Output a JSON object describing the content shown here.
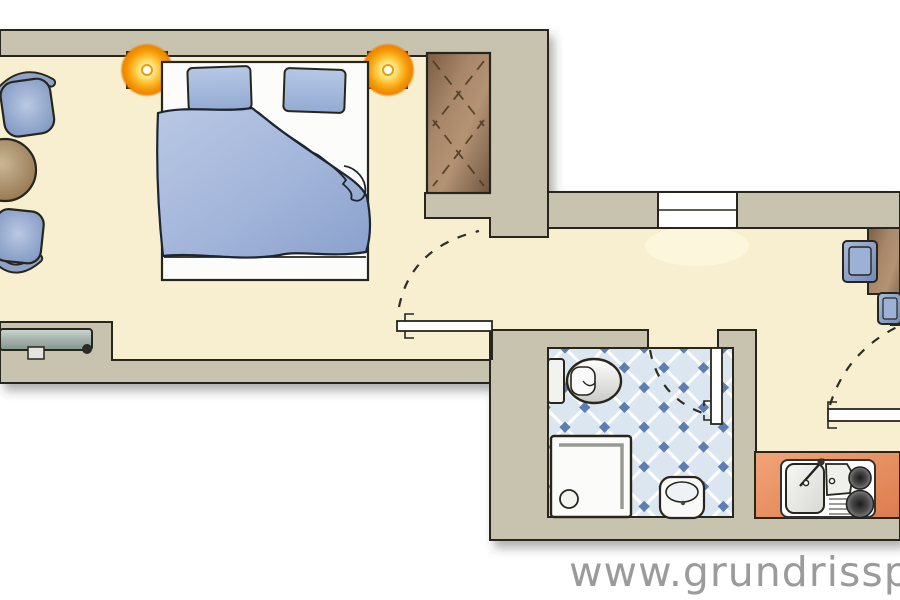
{
  "watermark": {
    "text": "www.grundrisspro"
  },
  "colors": {
    "page": "#ffffff",
    "wall": "#c8c3af",
    "line": "#26261e",
    "floor": "#f7efcf",
    "tile_bg": "#dce6f1",
    "tile_line": "#ffffff",
    "tile_dot": "#5b7eb5",
    "furniture_blue": "#8fa3c8",
    "blanket_blue": "#9db2d8",
    "wood_brown": "#a8876a",
    "table_tan": "#b59d7d",
    "desk_tan": "#c6b191",
    "counter_orange": "#e9956b",
    "lamp_orange": "#f59a07",
    "radiator_gray": "#a9b6af",
    "watermark_gray": "#9b9b9b"
  },
  "rooms": {
    "bedroom_living": {
      "label": "bedroom-living-area",
      "furniture": [
        "double-bed",
        "pillow",
        "pillow",
        "duvet",
        "wardrobe",
        "armchair",
        "armchair",
        "round-side-table",
        "radiator",
        "ceiling-lamp",
        "ceiling-lamp"
      ]
    },
    "hallway": {
      "label": "hallway",
      "features": [
        "window",
        "door-swing-to-bedroom"
      ]
    },
    "bathroom": {
      "label": "bathroom",
      "floor": "diagonal-blue-tiles",
      "furniture": [
        "toilet",
        "shower-tray",
        "washbasin"
      ],
      "features": [
        "door-swing"
      ]
    },
    "kitchen_living": {
      "label": "kitchen-living-room",
      "furniture": [
        "desk",
        "chair",
        "chair",
        "kitchenette-counter"
      ],
      "kitchenette": [
        "sink-basin",
        "drainer",
        "faucet",
        "two-burner-stove"
      ],
      "features": [
        "door-swing"
      ]
    }
  }
}
